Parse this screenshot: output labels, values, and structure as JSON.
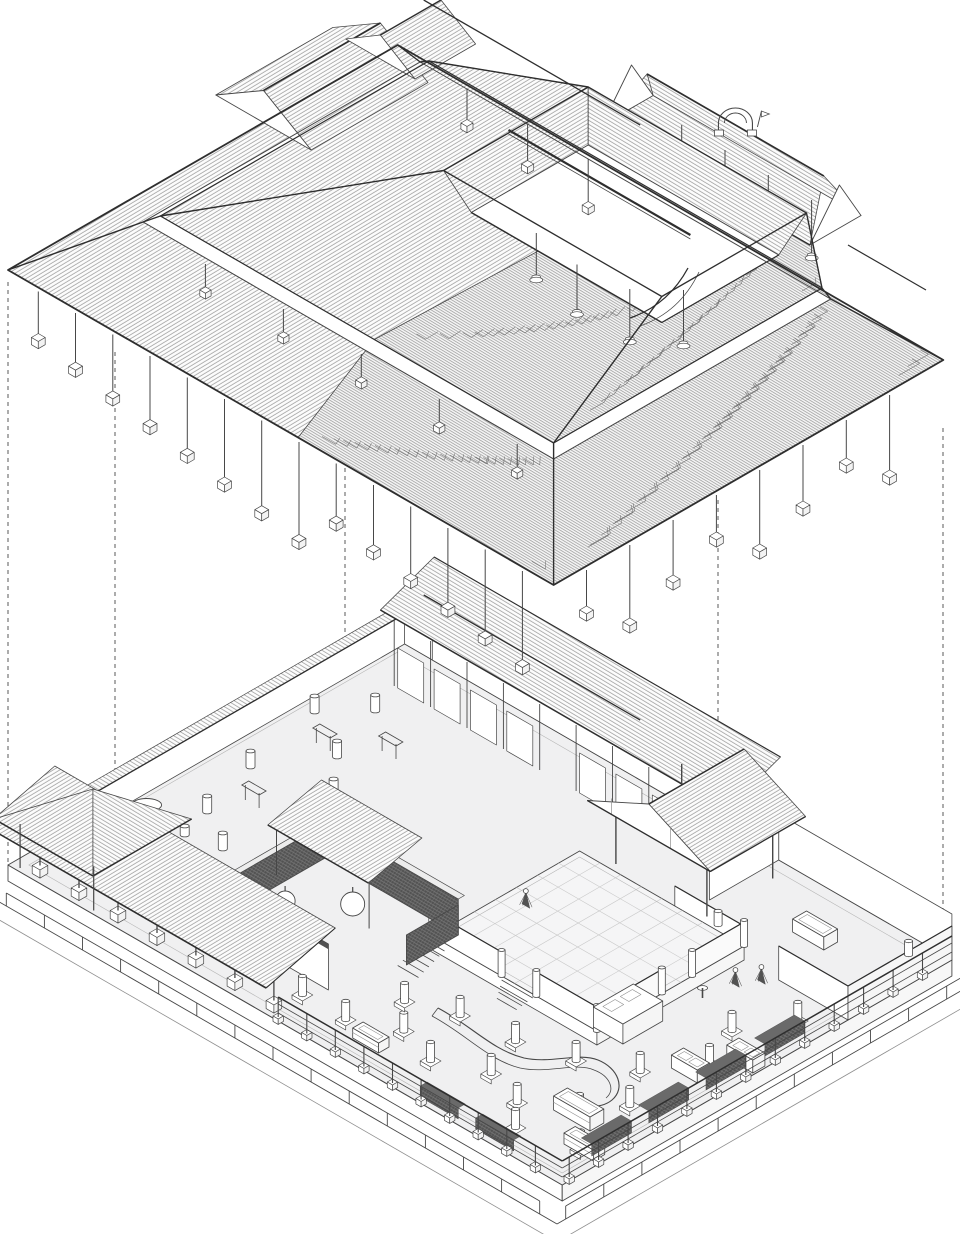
{
  "drawing": {
    "kind": "exploded-axonometric-architectural-drawing",
    "subject": "courtyard-building-roof-lifted-above-ground-floor",
    "levels": {
      "upper_label": "roof-assembly",
      "lower_label": "ground-floor-plan"
    }
  },
  "components": {
    "drawing_label": "exploded axonometric drawing of a courtyard building",
    "roof_label": "tiled roof assembly with courtyard opening",
    "ground_label": "ground floor plate with courtyard, verandas and railings",
    "guides_label": "dashed projection guide lines"
  },
  "colors": {
    "paper": "#ffffff",
    "ink": "#474747",
    "ink_bold": "#2e2e2e",
    "ink_light": "#8f8f8f",
    "hatch": "#9b9b9b",
    "hatch_dense": "#7d7d7d",
    "xray_line": "#6e6e6e",
    "floor": "#f0f0f1",
    "floor_court": "#f5f5f6",
    "roof_white": "#fcfcfc",
    "dark_fill": "#525252",
    "dark_top": "#6a6a6a",
    "mesh_line": "#8a8a8a",
    "tile_line": "#cacaca",
    "guide": "#5a5a5a",
    "border_light": "#b5b5b5"
  }
}
